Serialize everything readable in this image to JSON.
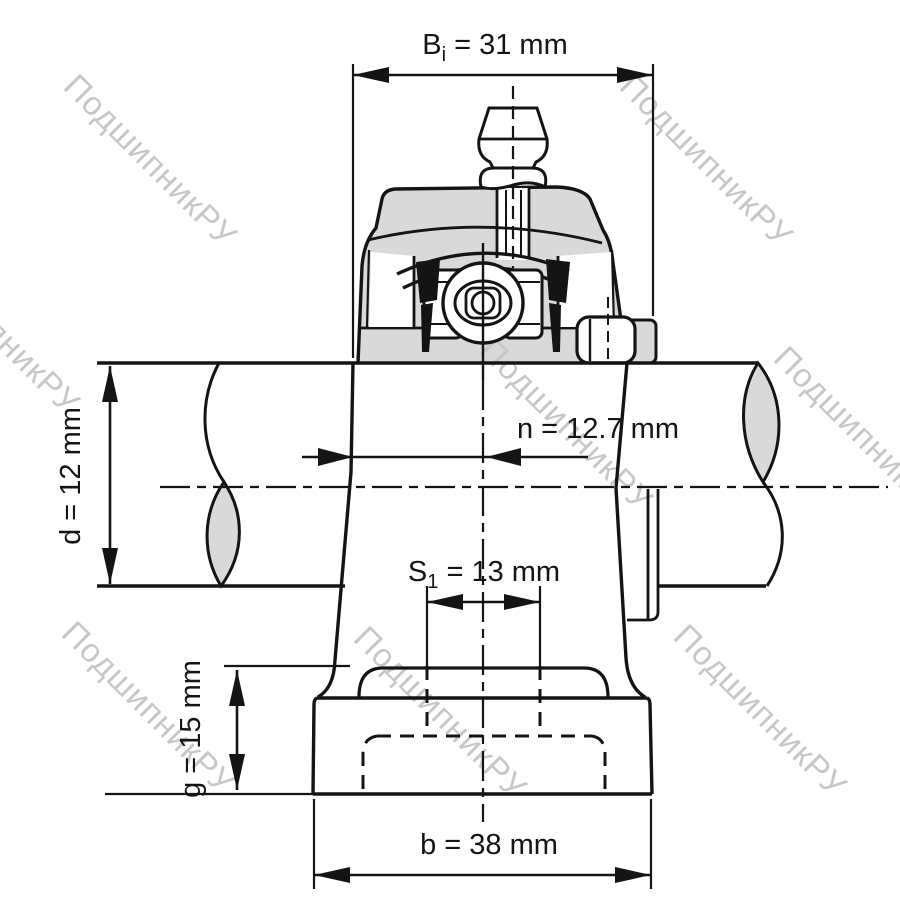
{
  "colors": {
    "line": "#141414",
    "section_fill": "#d9d9d9",
    "watermark": "#c7c7c7",
    "background": "#ffffff"
  },
  "watermark": {
    "text": "ПодшипникРУ"
  },
  "dimensions": {
    "bi": {
      "base": "B",
      "sub": "i",
      "rest": " = 31 mm",
      "value_mm": 31
    },
    "n": {
      "text": "n = 12.7 mm",
      "value_mm": 12.7
    },
    "s1": {
      "base": "S",
      "sub": "1",
      "rest": " = 13 mm",
      "value_mm": 13
    },
    "d": {
      "text": "d = 12 mm",
      "value_mm": 12
    },
    "g": {
      "text": "g = 15 mm",
      "value_mm": 15
    },
    "b": {
      "text": "b = 38 mm",
      "value_mm": 38
    }
  }
}
